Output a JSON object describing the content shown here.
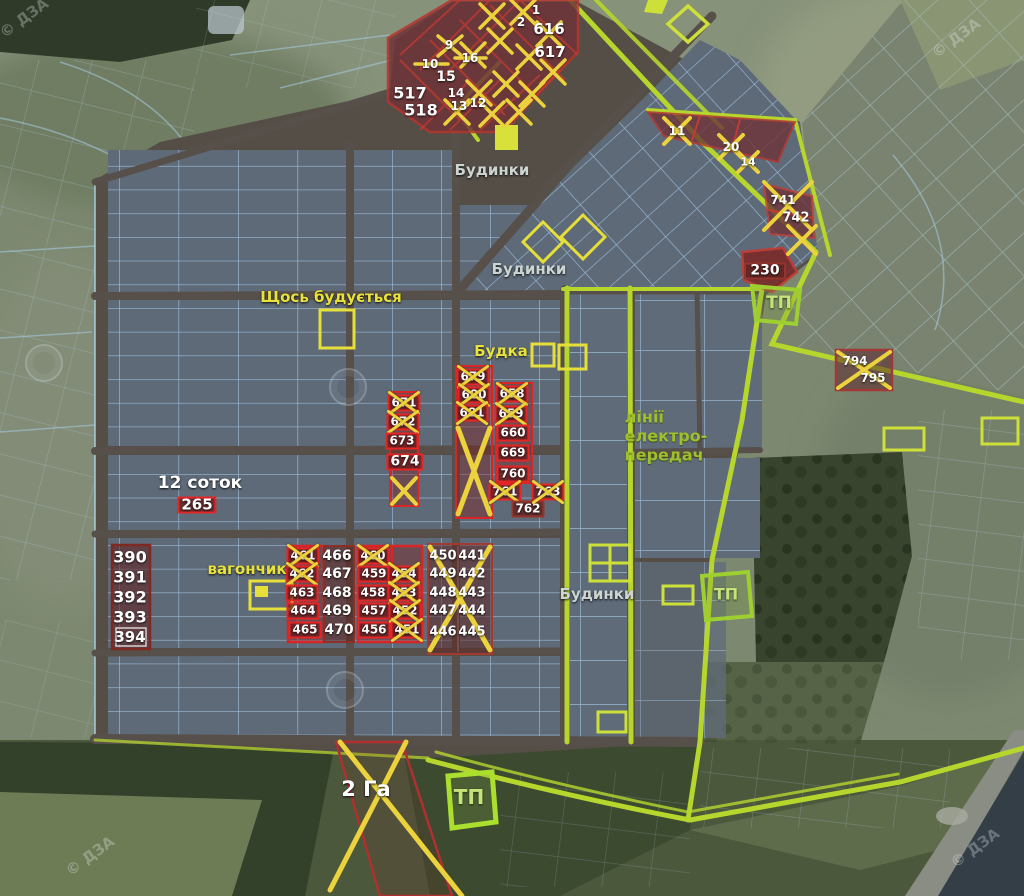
{
  "map_title": "land-plots-satellite-map",
  "colors": {
    "boundary_green": "#b6d62e",
    "plot_red": "#e62626",
    "plot_maroon": "#93352c",
    "sold_cross_yellow": "#ecd23c",
    "label_yellow": "#e8e23a",
    "label_green": "#9fc02c",
    "label_white": "#ffffff"
  },
  "labels": [
    {
      "t": "Будинки",
      "x": 492,
      "y": 170,
      "c": "gray"
    },
    {
      "t": "Будинки",
      "x": 529,
      "y": 269,
      "c": "gray"
    },
    {
      "t": "Будинки",
      "x": 597,
      "y": 594,
      "c": "gray"
    },
    {
      "t": "Щось будується",
      "x": 331,
      "y": 297,
      "c": "yellow"
    },
    {
      "t": "Будка",
      "x": 501,
      "y": 351,
      "c": "yellow"
    },
    {
      "t": "вагончик",
      "x": 247,
      "y": 569,
      "c": "yellow"
    },
    {
      "t": "12 соток",
      "x": 200,
      "y": 483,
      "c": "white",
      "fs": 17
    },
    {
      "t": "2 Га",
      "x": 366,
      "y": 789,
      "c": "white",
      "fs": 21
    },
    {
      "t": "лінії\nелектро-\nпередач",
      "x": 666,
      "y": 436,
      "c": "green",
      "fs": 16
    },
    {
      "t": "ТП",
      "x": 779,
      "y": 303,
      "c": "tp",
      "fs": 17
    },
    {
      "t": "ТП",
      "x": 726,
      "y": 594,
      "c": "tp",
      "fs": 16
    },
    {
      "t": "ТП",
      "x": 469,
      "y": 797,
      "c": "tp",
      "fs": 20
    }
  ],
  "plots": [
    {
      "n": "1",
      "x": 536,
      "y": 10,
      "s": "t"
    },
    {
      "n": "2",
      "x": 521,
      "y": 22,
      "s": "t"
    },
    {
      "n": "616",
      "x": 549,
      "y": 29,
      "s": "t",
      "fs": 15
    },
    {
      "n": "617",
      "x": 550,
      "y": 52,
      "s": "t",
      "fs": 15
    },
    {
      "n": "9",
      "x": 449,
      "y": 45,
      "s": "t"
    },
    {
      "n": "10",
      "x": 430,
      "y": 64,
      "s": "t"
    },
    {
      "n": "16",
      "x": 470,
      "y": 58,
      "s": "t"
    },
    {
      "n": "15",
      "x": 446,
      "y": 77,
      "s": "t",
      "fs": 14
    },
    {
      "n": "14",
      "x": 456,
      "y": 93,
      "s": "t"
    },
    {
      "n": "13",
      "x": 459,
      "y": 106,
      "s": "t"
    },
    {
      "n": "12",
      "x": 478,
      "y": 103,
      "s": "t"
    },
    {
      "n": "517",
      "x": 410,
      "y": 93,
      "s": "t",
      "fs": 16
    },
    {
      "n": "518",
      "x": 421,
      "y": 110,
      "s": "t",
      "fs": 16
    },
    {
      "n": "11",
      "x": 677,
      "y": 131,
      "s": "t"
    },
    {
      "n": "20",
      "x": 731,
      "y": 147,
      "s": "t"
    },
    {
      "n": "14",
      "x": 748,
      "y": 162,
      "s": "t",
      "fs": 11
    },
    {
      "n": "741",
      "x": 783,
      "y": 200,
      "s": "t",
      "fs": 12
    },
    {
      "n": "742",
      "x": 796,
      "y": 218,
      "s": "t",
      "fs": 13
    },
    {
      "n": "230",
      "x": 765,
      "y": 271,
      "s": "m",
      "fs": 14,
      "w": 34
    },
    {
      "n": "671",
      "x": 404,
      "y": 403,
      "s": "r",
      "c": 1
    },
    {
      "n": "672",
      "x": 403,
      "y": 422,
      "s": "r",
      "c": 1
    },
    {
      "n": "673",
      "x": 402,
      "y": 441,
      "s": "r"
    },
    {
      "n": "674",
      "x": 405,
      "y": 462,
      "s": "r",
      "fs": 14
    },
    {
      "n": "679",
      "x": 473,
      "y": 377,
      "s": "r",
      "c": 1
    },
    {
      "n": "680",
      "x": 474,
      "y": 395,
      "s": "r",
      "c": 1
    },
    {
      "n": "681",
      "x": 472,
      "y": 413,
      "s": "r",
      "c": 1
    },
    {
      "n": "658",
      "x": 512,
      "y": 394,
      "s": "r",
      "c": 1
    },
    {
      "n": "659",
      "x": 511,
      "y": 414,
      "s": "r",
      "c": 1
    },
    {
      "n": "660",
      "x": 513,
      "y": 433,
      "s": "r"
    },
    {
      "n": "669",
      "x": 513,
      "y": 453,
      "s": "r"
    },
    {
      "n": "760",
      "x": 513,
      "y": 474,
      "s": "r"
    },
    {
      "n": "761",
      "x": 505,
      "y": 492,
      "s": "r",
      "c": 1
    },
    {
      "n": "762",
      "x": 528,
      "y": 509,
      "s": "m"
    },
    {
      "n": "763",
      "x": 548,
      "y": 492,
      "s": "r",
      "c": 1
    },
    {
      "n": "265",
      "x": 197,
      "y": 505,
      "s": "r",
      "fs": 15,
      "w": 30
    },
    {
      "n": "390",
      "x": 130,
      "y": 557,
      "s": "t",
      "fs": 16
    },
    {
      "n": "391",
      "x": 130,
      "y": 577,
      "s": "t",
      "fs": 16
    },
    {
      "n": "392",
      "x": 130,
      "y": 597,
      "s": "t",
      "fs": 16
    },
    {
      "n": "393",
      "x": 130,
      "y": 617,
      "s": "t",
      "fs": 16
    },
    {
      "n": "394",
      "x": 130,
      "y": 637,
      "s": "t",
      "fs": 15
    },
    {
      "n": "461",
      "x": 303,
      "y": 556,
      "s": "r",
      "c": 1
    },
    {
      "n": "462",
      "x": 302,
      "y": 574,
      "s": "r",
      "c": 1
    },
    {
      "n": "463",
      "x": 302,
      "y": 593,
      "s": "r"
    },
    {
      "n": "464",
      "x": 303,
      "y": 611,
      "s": "r"
    },
    {
      "n": "465",
      "x": 305,
      "y": 630,
      "s": "r"
    },
    {
      "n": "466",
      "x": 337,
      "y": 556,
      "s": "t",
      "fs": 14
    },
    {
      "n": "467",
      "x": 337,
      "y": 574,
      "s": "t",
      "fs": 14
    },
    {
      "n": "468",
      "x": 337,
      "y": 593,
      "s": "t",
      "fs": 14
    },
    {
      "n": "469",
      "x": 337,
      "y": 611,
      "s": "t",
      "fs": 14
    },
    {
      "n": "470",
      "x": 339,
      "y": 630,
      "s": "t",
      "fs": 14
    },
    {
      "n": "460",
      "x": 373,
      "y": 556,
      "s": "r",
      "c": 1
    },
    {
      "n": "459",
      "x": 374,
      "y": 574,
      "s": "r"
    },
    {
      "n": "458",
      "x": 373,
      "y": 593,
      "s": "r"
    },
    {
      "n": "457",
      "x": 374,
      "y": 611,
      "s": "r"
    },
    {
      "n": "456",
      "x": 374,
      "y": 630,
      "s": "r"
    },
    {
      "n": "454",
      "x": 404,
      "y": 574,
      "s": "r",
      "c": 1
    },
    {
      "n": "453",
      "x": 404,
      "y": 593,
      "s": "r",
      "c": 1
    },
    {
      "n": "452",
      "x": 405,
      "y": 611,
      "s": "r",
      "c": 1
    },
    {
      "n": "451",
      "x": 407,
      "y": 630,
      "s": "r",
      "c": 1
    },
    {
      "n": "450",
      "x": 443,
      "y": 556,
      "s": "t",
      "fs": 13
    },
    {
      "n": "449",
      "x": 443,
      "y": 574,
      "s": "t",
      "fs": 13
    },
    {
      "n": "448",
      "x": 443,
      "y": 593,
      "s": "t",
      "fs": 13
    },
    {
      "n": "447",
      "x": 443,
      "y": 611,
      "s": "t",
      "fs": 13
    },
    {
      "n": "446",
      "x": 443,
      "y": 632,
      "s": "t",
      "fs": 13
    },
    {
      "n": "441",
      "x": 472,
      "y": 556,
      "s": "t",
      "fs": 13
    },
    {
      "n": "442",
      "x": 472,
      "y": 574,
      "s": "t",
      "fs": 13
    },
    {
      "n": "443",
      "x": 472,
      "y": 593,
      "s": "t",
      "fs": 13
    },
    {
      "n": "444",
      "x": 472,
      "y": 611,
      "s": "t",
      "fs": 13
    },
    {
      "n": "445",
      "x": 472,
      "y": 632,
      "s": "t",
      "fs": 13
    },
    {
      "n": "794",
      "x": 855,
      "y": 361,
      "s": "t",
      "fs": 12
    },
    {
      "n": "795",
      "x": 873,
      "y": 378,
      "s": "t",
      "fs": 12
    }
  ],
  "watermark": {
    "text": "© ДЗА",
    "text_spots": [
      [
        24,
        18
      ],
      [
        956,
        38
      ],
      [
        90,
        856
      ],
      [
        975,
        848
      ]
    ],
    "ring_spots": [
      [
        44,
        363
      ],
      [
        348,
        387
      ],
      [
        345,
        690
      ]
    ]
  }
}
